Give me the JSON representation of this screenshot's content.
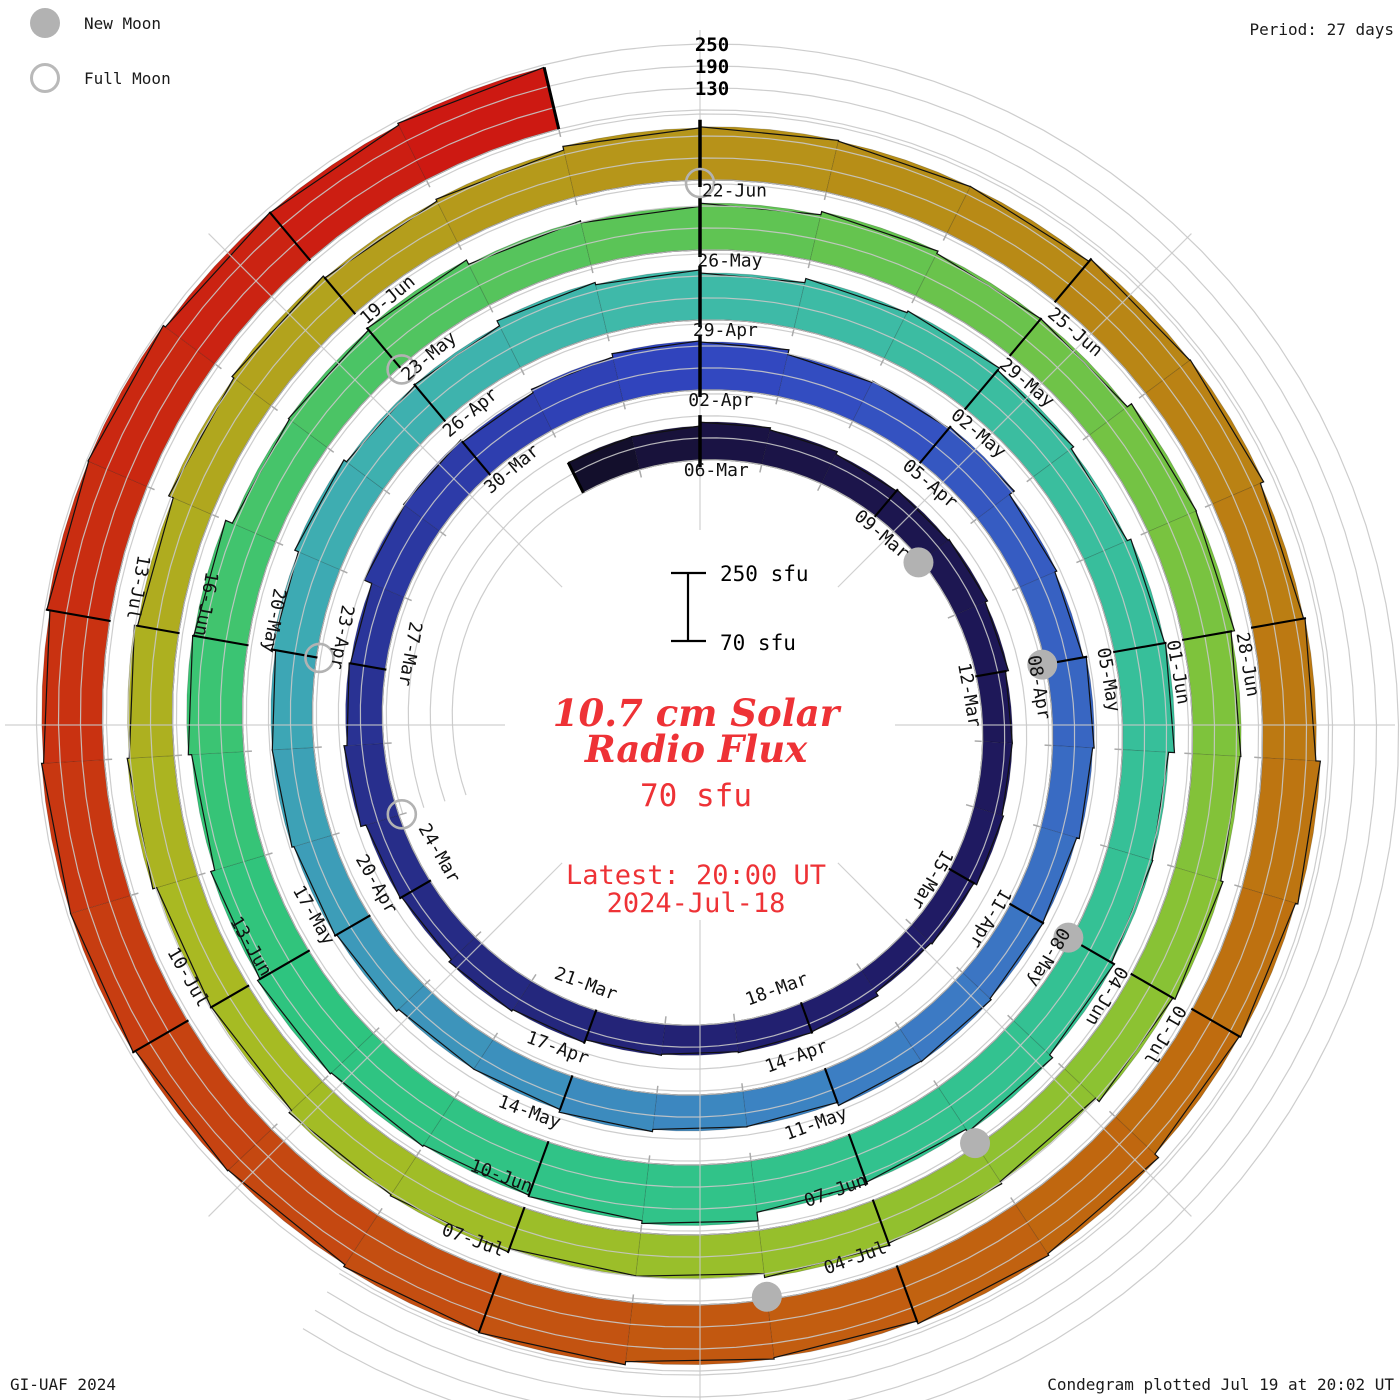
{
  "legend": {
    "new_moon_label": "New Moon",
    "full_moon_label": "Full Moon"
  },
  "period_label": "Period: 27 days",
  "radial_axis_labels": [
    "250",
    "190",
    "130"
  ],
  "scale_bar": {
    "top_label": "250 sfu",
    "bottom_label": "70 sfu"
  },
  "center": {
    "title_line1": "10.7 cm Solar",
    "title_line2": "Radio Flux",
    "current_flux_label": "70 sfu",
    "latest_line1": "Latest: 20:00 UT",
    "latest_line2": "2024-Jul-18"
  },
  "footer": {
    "left": "GI-UAF 2024",
    "right": "Condegram plotted Jul 19 at 20:02 UT"
  },
  "colors": {
    "moon_gray": "#b2b2b2",
    "grid_gray": "#c8c8c8",
    "tick_black": "#000000",
    "label_black": "#111111",
    "title_red": "#ee3236"
  },
  "chart_data": {
    "type": "spiral_bar_condegram",
    "title": "10.7 cm Solar Radio Flux",
    "period_days": 27,
    "start_date": "04-Mar-2024",
    "end_date": "18-Jul-2024",
    "latest_value_sfu": 70,
    "flux_baseline_sfu": 70,
    "flux_gridlines_sfu": [
      130,
      190,
      250
    ],
    "tick_interval_days": 3,
    "date_labels": [
      "06-Mar",
      "09-Mar",
      "12-Mar",
      "15-Mar",
      "18-Mar",
      "21-Mar",
      "24-Mar",
      "27-Mar",
      "30-Mar",
      "02-Apr",
      "05-Apr",
      "08-Apr",
      "11-Apr",
      "14-Apr",
      "17-Apr",
      "20-Apr",
      "23-Apr",
      "26-Apr",
      "29-Apr",
      "02-May",
      "05-May",
      "08-May",
      "11-May",
      "14-May",
      "17-May",
      "20-May",
      "23-May",
      "26-May",
      "29-May",
      "01-Jun",
      "04-Jun",
      "07-Jun",
      "10-Jun",
      "13-Jun",
      "16-Jun",
      "19-Jun",
      "22-Jun",
      "25-Jun",
      "28-Jun",
      "01-Jul",
      "04-Jul",
      "07-Jul",
      "10-Jul",
      "13-Jul"
    ],
    "flux_segments_sfu": [
      168,
      162,
      158,
      152,
      150,
      155,
      165,
      175,
      188,
      196,
      192,
      184,
      176,
      170,
      168,
      175,
      188,
      198,
      206,
      212,
      206,
      198,
      214,
      232,
      226,
      214,
      204,
      198,
      202,
      206,
      202,
      196,
      192,
      188,
      192,
      200,
      208,
      214,
      220,
      226,
      230,
      234,
      238,
      244,
      240,
      236
    ],
    "band_color_stops": [
      [
        -3,
        "#0b0b16"
      ],
      [
        0,
        "#1a1342"
      ],
      [
        10,
        "#201b66"
      ],
      [
        20,
        "#28308f"
      ],
      [
        27,
        "#3145c0"
      ],
      [
        38,
        "#3c7cc4"
      ],
      [
        48,
        "#3da8b4"
      ],
      [
        54,
        "#3fbaa8"
      ],
      [
        63,
        "#34c194"
      ],
      [
        72,
        "#2ec47e"
      ],
      [
        81,
        "#5ec455"
      ],
      [
        90,
        "#8ac233"
      ],
      [
        99,
        "#a8bb22"
      ],
      [
        106,
        "#b59c1c"
      ],
      [
        112,
        "#b98414"
      ],
      [
        118,
        "#c06a0f"
      ],
      [
        124,
        "#c44b11"
      ],
      [
        129,
        "#c92f11"
      ],
      [
        134,
        "#cd1612"
      ]
    ],
    "new_moons": [
      "10-Mar",
      "08-Apr",
      "08-May",
      "06-Jun",
      "05-Jul"
    ],
    "full_moons": [
      "25-Mar",
      "23-Apr",
      "23-May",
      "22-Jun"
    ]
  }
}
